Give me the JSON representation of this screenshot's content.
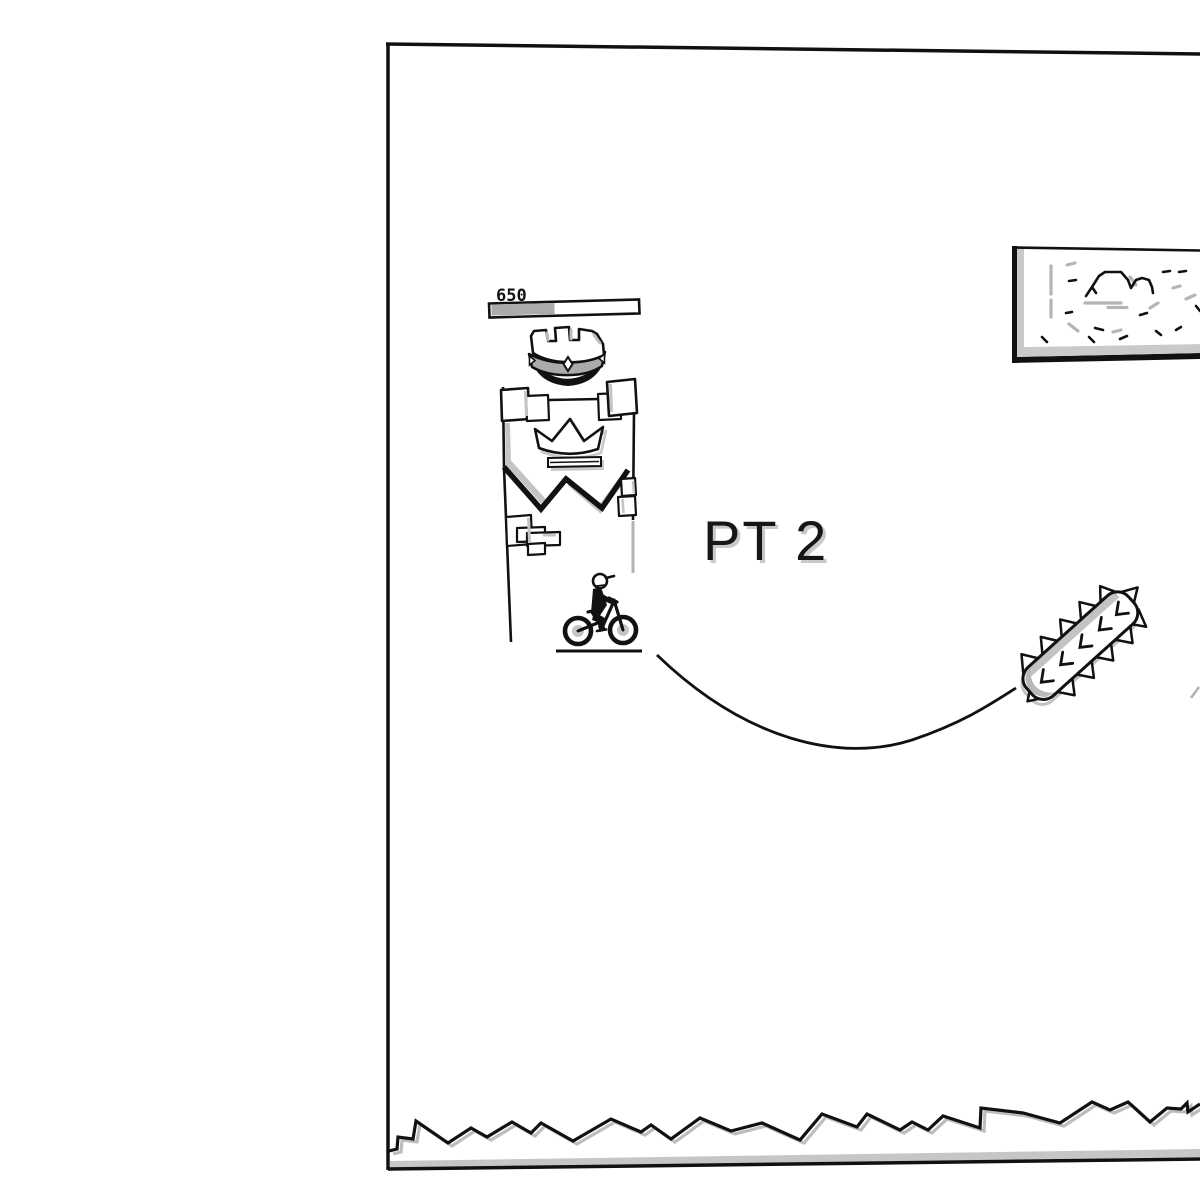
{
  "hud": {
    "score": "650",
    "progress_ratio": 0.44,
    "progress_fill_width": "63"
  },
  "level": {
    "title": "PT 2"
  },
  "colors": {
    "ink": "#111111",
    "shadow_gray": "#c2c2c2",
    "band_gray": "#ababab",
    "hub_gray": "#c6c6c6",
    "background": "#ffffff"
  },
  "scene": {
    "elements": [
      "level-frame",
      "progress-bar",
      "king-crown",
      "checkpoint-banner",
      "crown-emblem",
      "stickman-rider",
      "bicycle",
      "track-curve",
      "spiked-log-obstacle",
      "framed-sign",
      "jagged-terrain"
    ]
  }
}
